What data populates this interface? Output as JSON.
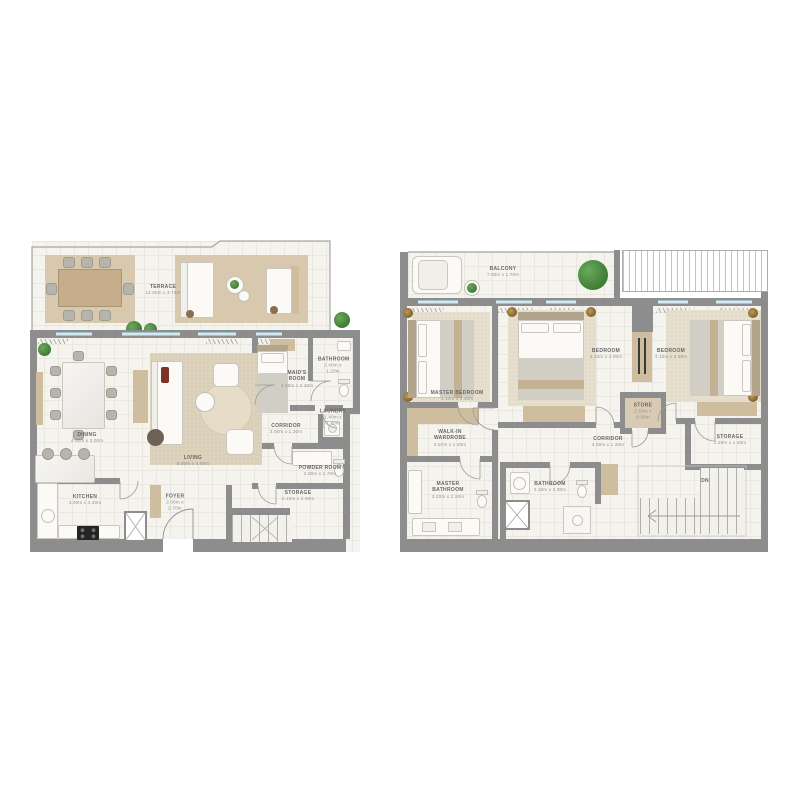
{
  "document": {
    "type": "residential floor plan sheet",
    "background": "#ffffff"
  },
  "palette": {
    "wall": "#8d8d8d",
    "floor": "#f4f3ee",
    "rug_beige": "#d8c9ae",
    "wardrobe_beige": "#cfbd9f",
    "window_blue": "#d6e8ee",
    "plant_green": "#3e7c35",
    "label_text": "#676767"
  },
  "plan1": {
    "rooms": {
      "terrace": {
        "name": "TERRACE",
        "dims": "12.00m x 3.70m"
      },
      "dining": {
        "name": "DINING",
        "dims": "4.00m x 3.00m"
      },
      "living": {
        "name": "LIVING",
        "dims": "5.00m x 4.00m"
      },
      "maids_room": {
        "name": "MAID'S ROOM",
        "dims": "2.40m x 3.40m"
      },
      "bathroom": {
        "name": "BATHROOM",
        "dims": "2.40m x 1.20m"
      },
      "laundry": {
        "name": "LAUNDRY",
        "dims": "1.40m x 1.40m"
      },
      "corridor": {
        "name": "CORRIDOR",
        "dims": "3.00m x 1.20m"
      },
      "powder_room": {
        "name": "POWDER ROOM",
        "dims": "2.00m x 1.70m"
      },
      "kitchen": {
        "name": "KITCHEN",
        "dims": "3.00m x 4.20m"
      },
      "foyer": {
        "name": "FOYER",
        "dims": "2.00m x 2.70m"
      },
      "storage": {
        "name": "STORAGE",
        "dims": "2.10m x 2.00m"
      }
    }
  },
  "plan2": {
    "rooms": {
      "balcony": {
        "name": "BALCONY",
        "dims": "7.00m x 1.70m"
      },
      "master_bedroom": {
        "name": "MASTER BEDROOM",
        "dims": "4.10m x 3.40m"
      },
      "bedroom_2": {
        "name": "BEDROOM",
        "dims": "4.10m x 3.00m"
      },
      "bedroom_3": {
        "name": "BEDROOM",
        "dims": "4.10m x 3.00m"
      },
      "store": {
        "name": "STORE",
        "dims": "1.50m x 0.90m"
      },
      "walk_in_wardrobe": {
        "name": "WALK-IN WARDROBE",
        "dims": "2.07m x 1.40m"
      },
      "master_bathroom": {
        "name": "MASTER BATHROOM",
        "dims": "3.20m x 2.20m"
      },
      "bathroom": {
        "name": "BATHROOM",
        "dims": "3.10m x 2.00m"
      },
      "corridor": {
        "name": "CORRIDOR",
        "dims": "4.00m x 1.20m"
      },
      "storage": {
        "name": "STORAGE",
        "dims": "2.20m x 1.40m"
      },
      "stairs": {
        "name": "DN"
      }
    }
  }
}
